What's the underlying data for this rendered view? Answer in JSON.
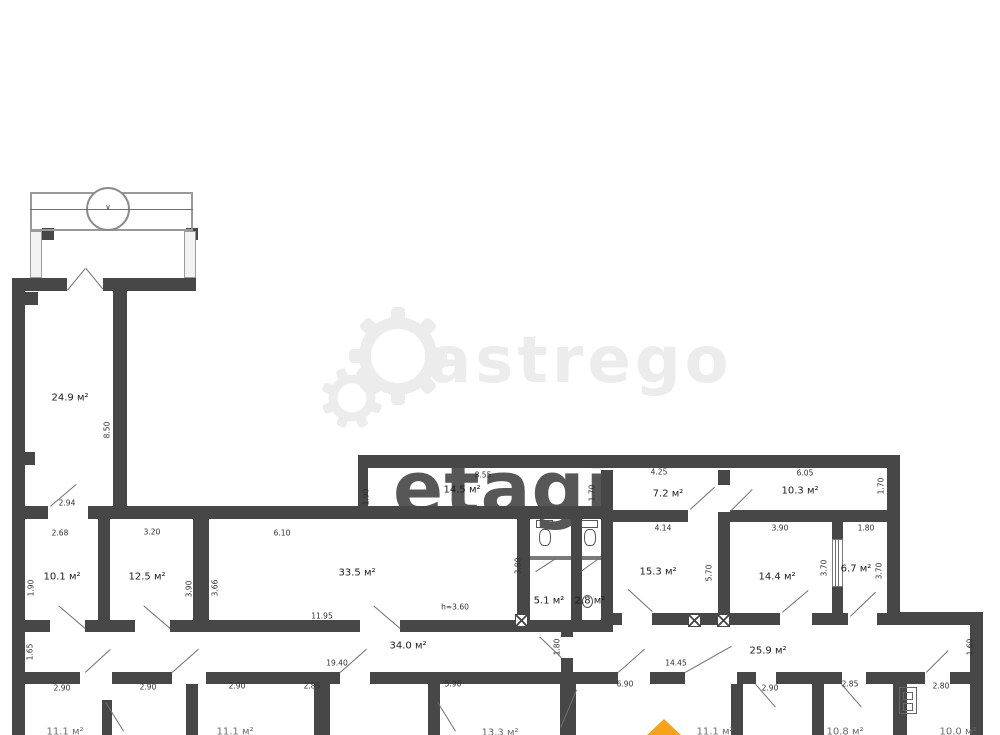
{
  "watermarks": {
    "astrego_text": "astrego",
    "etagi_text": "etagi"
  },
  "colors": {
    "wall": "#474747",
    "leaf": "#6f6f6f",
    "dim": "#2f2f2f",
    "room": "#1c1c1c",
    "thin": "#999999",
    "watermark_light": "#ececec",
    "watermark_dark": "#4f4f4f",
    "accent_orange": "#f6a21c"
  },
  "plan": {
    "walls": [
      [
        12,
        278,
        55,
        13
      ],
      [
        103,
        278,
        93,
        13
      ],
      [
        12,
        278,
        13,
        457
      ],
      [
        113,
        278,
        14,
        239
      ],
      [
        25,
        292,
        13,
        13
      ],
      [
        25,
        452,
        10,
        13
      ],
      [
        12,
        506,
        36,
        13
      ],
      [
        88,
        506,
        522,
        13
      ],
      [
        358,
        455,
        542,
        13
      ],
      [
        358,
        455,
        10,
        64
      ],
      [
        98,
        519,
        12,
        106
      ],
      [
        193,
        519,
        16,
        106
      ],
      [
        12,
        620,
        38,
        12
      ],
      [
        85,
        620,
        50,
        12
      ],
      [
        170,
        620,
        190,
        12
      ],
      [
        400,
        620,
        130,
        12
      ],
      [
        517,
        506,
        13,
        126
      ],
      [
        571,
        506,
        11,
        126
      ],
      [
        601,
        470,
        12,
        162
      ],
      [
        530,
        620,
        82,
        12
      ],
      [
        561,
        632,
        12,
        5
      ],
      [
        561,
        658,
        12,
        14
      ],
      [
        612,
        510,
        76,
        12
      ],
      [
        718,
        470,
        12,
        15
      ],
      [
        718,
        512,
        12,
        113
      ],
      [
        730,
        510,
        157,
        12
      ],
      [
        887,
        455,
        13,
        170
      ],
      [
        832,
        519,
        11,
        22
      ],
      [
        832,
        586,
        11,
        36
      ],
      [
        612,
        613,
        10,
        12
      ],
      [
        652,
        613,
        128,
        12
      ],
      [
        812,
        613,
        36,
        12
      ],
      [
        877,
        613,
        10,
        12
      ],
      [
        887,
        612,
        96,
        13
      ],
      [
        970,
        612,
        13,
        123
      ],
      [
        12,
        672,
        68,
        12
      ],
      [
        112,
        672,
        60,
        12
      ],
      [
        206,
        672,
        134,
        12
      ],
      [
        370,
        672,
        248,
        12
      ],
      [
        650,
        672,
        35,
        12
      ],
      [
        737,
        672,
        19,
        12
      ],
      [
        776,
        672,
        66,
        12
      ],
      [
        866,
        672,
        59,
        12
      ],
      [
        950,
        672,
        33,
        12
      ],
      [
        102,
        700,
        10,
        35
      ],
      [
        186,
        684,
        12,
        51
      ],
      [
        314,
        684,
        16,
        51
      ],
      [
        428,
        684,
        12,
        51
      ],
      [
        560,
        684,
        16,
        51
      ],
      [
        731,
        684,
        12,
        51
      ],
      [
        812,
        684,
        12,
        51
      ],
      [
        893,
        684,
        14,
        51
      ],
      [
        42,
        228,
        12,
        12
      ],
      [
        186,
        228,
        12,
        12
      ]
    ],
    "thin_rects": [
      {
        "x": 30,
        "y": 192,
        "w": 163,
        "h": 39,
        "bw": 2,
        "bc": "#999"
      },
      {
        "x": 30,
        "y": 231,
        "w": 12,
        "h": 47,
        "bw": 1.5,
        "bc": "#9a9a9a",
        "fill": "#f2f2f2"
      },
      {
        "x": 184,
        "y": 231,
        "w": 12,
        "h": 47,
        "bw": 1.5,
        "bc": "#9a9a9a",
        "fill": "#f2f2f2"
      },
      {
        "x": 86,
        "y": 187,
        "w": 44,
        "h": 44,
        "bw": 2,
        "bc": "#8a8a8a",
        "br": "50%",
        "fill": "#fff",
        "name": "entrance-circle-symbol"
      },
      {
        "x": 832,
        "y": 539,
        "w": 11,
        "h": 48,
        "bw": 1,
        "bc": "#7a7a7a",
        "fill": "#fff",
        "name": "glazed-partition"
      },
      {
        "x": 536,
        "y": 520,
        "w": 17,
        "h": 8,
        "bw": 1.5,
        "bc": "#555",
        "name": "toilet-icon"
      },
      {
        "x": 539,
        "y": 529,
        "w": 12,
        "h": 17,
        "bw": 1.5,
        "bc": "#555",
        "br": "40%",
        "name": "toilet-icon"
      },
      {
        "x": 581,
        "y": 520,
        "w": 17,
        "h": 8,
        "bw": 1.5,
        "bc": "#555",
        "name": "toilet-icon"
      },
      {
        "x": 584,
        "y": 529,
        "w": 12,
        "h": 17,
        "bw": 1.5,
        "bc": "#555",
        "br": "40%",
        "name": "toilet-icon"
      },
      {
        "x": 582,
        "y": 595,
        "w": 11,
        "h": 13,
        "bw": 1.5,
        "bc": "#555",
        "br": "50%",
        "name": "sink-icon"
      },
      {
        "x": 899,
        "y": 687,
        "w": 18,
        "h": 27,
        "bw": 1.5,
        "bc": "#666",
        "name": "shaft-panel-symbol"
      },
      {
        "x": 903,
        "y": 692,
        "w": 10,
        "h": 8,
        "bw": 1,
        "bc": "#666"
      },
      {
        "x": 903,
        "y": 703,
        "w": 10,
        "h": 8,
        "bw": 1,
        "bc": "#666"
      },
      {
        "x": 530,
        "y": 556,
        "w": 41,
        "h": 4,
        "fill": "#7a7a7a"
      },
      {
        "x": 582,
        "y": 556,
        "w": 19,
        "h": 4,
        "fill": "#7a7a7a"
      }
    ],
    "lines": [
      [
        30,
        209,
        193,
        209
      ],
      [
        67,
        290,
        85,
        268
      ],
      [
        103,
        290,
        85,
        268
      ],
      [
        50,
        506,
        76,
        484
      ],
      [
        85,
        629,
        58,
        606
      ],
      [
        170,
        629,
        143,
        606
      ],
      [
        400,
        629,
        373,
        606
      ],
      [
        556,
        559,
        536,
        572
      ],
      [
        599,
        559,
        581,
        572
      ],
      [
        561,
        658,
        539,
        637
      ],
      [
        652,
        612,
        628,
        590
      ],
      [
        730,
        511,
        752,
        489
      ],
      [
        690,
        509,
        714,
        487
      ],
      [
        782,
        612,
        808,
        590
      ],
      [
        850,
        616,
        875,
        592
      ],
      [
        85,
        672,
        110,
        649
      ],
      [
        172,
        672,
        198,
        649
      ],
      [
        340,
        672,
        366,
        649
      ],
      [
        618,
        672,
        644,
        649
      ],
      [
        685,
        672,
        731,
        646
      ],
      [
        756,
        684,
        776,
        707
      ],
      [
        842,
        684,
        862,
        707
      ],
      [
        926,
        672,
        948,
        650
      ],
      [
        106,
        702,
        124,
        731
      ],
      [
        438,
        702,
        456,
        731
      ],
      [
        577,
        690,
        561,
        728
      ],
      [
        836,
        540,
        836,
        587
      ],
      [
        839,
        540,
        839,
        587
      ]
    ],
    "xboxes": [
      [
        515,
        614
      ],
      [
        688,
        614
      ],
      [
        717,
        614
      ]
    ],
    "rooms": [
      {
        "t": "24.9 м²",
        "x": 70,
        "y": 398
      },
      {
        "t": "10.1 м²",
        "x": 62,
        "y": 577
      },
      {
        "t": "12.5 м²",
        "x": 147,
        "y": 577
      },
      {
        "t": "33.5 м²",
        "x": 357,
        "y": 573
      },
      {
        "t": "14.5 м²",
        "x": 462,
        "y": 490
      },
      {
        "t": "5.1 м²",
        "x": 549,
        "y": 601
      },
      {
        "t": "2.8 м²",
        "x": 590,
        "y": 601
      },
      {
        "t": "7.2 м²",
        "x": 668,
        "y": 494
      },
      {
        "t": "10.3 м²",
        "x": 800,
        "y": 491
      },
      {
        "t": "15.3 м²",
        "x": 658,
        "y": 572
      },
      {
        "t": "14.4 м²",
        "x": 777,
        "y": 577
      },
      {
        "t": "6.7 м²",
        "x": 856,
        "y": 569
      },
      {
        "t": "34.0 м²",
        "x": 408,
        "y": 646
      },
      {
        "t": "25.9 м²",
        "x": 768,
        "y": 651
      }
    ],
    "dims": [
      {
        "t": "2.94",
        "x": 67,
        "y": 503
      },
      {
        "t": "2.68",
        "x": 60,
        "y": 533
      },
      {
        "t": "8.50",
        "x": 107,
        "y": 430,
        "rot": 1
      },
      {
        "t": "1.90",
        "x": 31,
        "y": 588,
        "rot": 1
      },
      {
        "t": "3.20",
        "x": 152,
        "y": 532
      },
      {
        "t": "3.90",
        "x": 189,
        "y": 589,
        "rot": 1
      },
      {
        "t": "3.66",
        "x": 215,
        "y": 588,
        "rot": 1
      },
      {
        "t": "6.10",
        "x": 282,
        "y": 533
      },
      {
        "t": "11.95",
        "x": 322,
        "y": 616
      },
      {
        "t": "h=3.60",
        "x": 455,
        "y": 607
      },
      {
        "t": "8.55",
        "x": 483,
        "y": 475
      },
      {
        "t": "1.90",
        "x": 366,
        "y": 497,
        "rot": 1
      },
      {
        "t": "1.70",
        "x": 592,
        "y": 493,
        "rot": 1
      },
      {
        "t": "4.25",
        "x": 659,
        "y": 472
      },
      {
        "t": "6.05",
        "x": 805,
        "y": 473
      },
      {
        "t": "1.70",
        "x": 881,
        "y": 486,
        "rot": 1
      },
      {
        "t": "3.80",
        "x": 518,
        "y": 566,
        "rot": 1
      },
      {
        "t": "4.14",
        "x": 663,
        "y": 528
      },
      {
        "t": "3.90",
        "x": 780,
        "y": 528
      },
      {
        "t": "1.80",
        "x": 866,
        "y": 528
      },
      {
        "t": "5.70",
        "x": 709,
        "y": 573,
        "rot": 1
      },
      {
        "t": "3.70",
        "x": 824,
        "y": 568,
        "rot": 1
      },
      {
        "t": "3.70",
        "x": 879,
        "y": 571,
        "rot": 1
      },
      {
        "t": "19.40",
        "x": 337,
        "y": 663
      },
      {
        "t": "14.45",
        "x": 676,
        "y": 663
      },
      {
        "t": "1.65",
        "x": 30,
        "y": 652,
        "rot": 1
      },
      {
        "t": "1.80",
        "x": 557,
        "y": 647,
        "rot": 1
      },
      {
        "t": "1.60",
        "x": 970,
        "y": 647,
        "rot": 1
      },
      {
        "t": "2.90",
        "x": 62,
        "y": 688
      },
      {
        "t": "2.90",
        "x": 148,
        "y": 687
      },
      {
        "t": "2.90",
        "x": 237,
        "y": 686
      },
      {
        "t": "2.85",
        "x": 312,
        "y": 686
      },
      {
        "t": "5.90",
        "x": 453,
        "y": 684
      },
      {
        "t": "6.90",
        "x": 625,
        "y": 684
      },
      {
        "t": "2.90",
        "x": 770,
        "y": 688
      },
      {
        "t": "2.85",
        "x": 850,
        "y": 684
      },
      {
        "t": "2.80",
        "x": 941,
        "y": 686
      },
      {
        "t": "∨",
        "x": 108,
        "y": 207
      }
    ],
    "partials": [
      {
        "t": "11.1 м²",
        "x": 65,
        "y": 732
      },
      {
        "t": "11.1 м²",
        "x": 235,
        "y": 732
      },
      {
        "t": "13.3 м²",
        "x": 500,
        "y": 733
      },
      {
        "t": "11.1 м²",
        "x": 715,
        "y": 732
      },
      {
        "t": "10.8 м²",
        "x": 845,
        "y": 732
      },
      {
        "t": "10.0 м²",
        "x": 958,
        "y": 732
      }
    ]
  }
}
